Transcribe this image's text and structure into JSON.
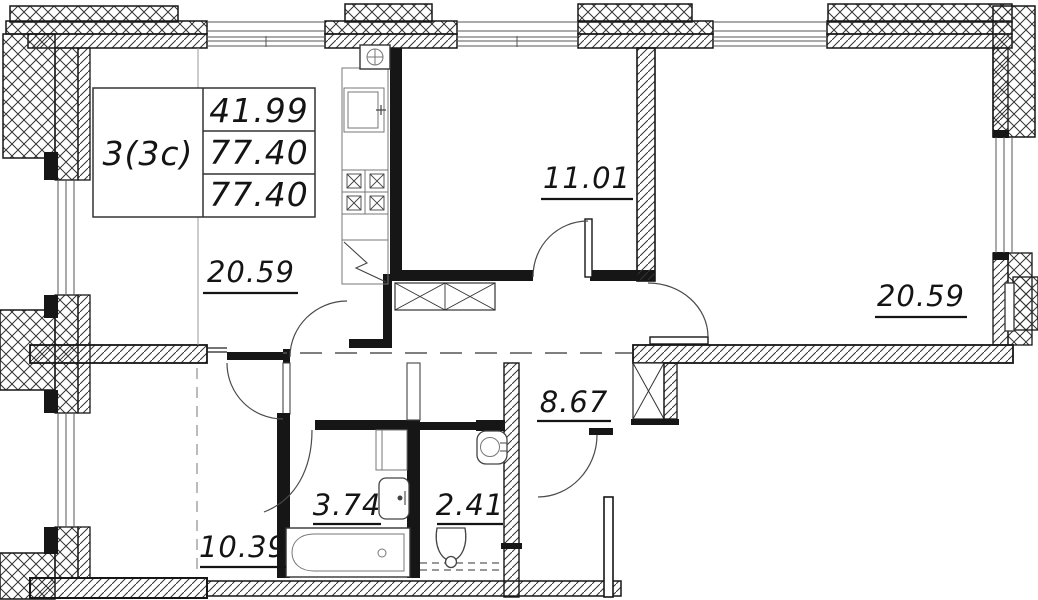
{
  "plan": {
    "title_block": {
      "unit_type": "3(3c)",
      "area_rows": [
        "41.99",
        "77.40",
        "77.40"
      ]
    },
    "room_labels": {
      "living": "20.59",
      "bedroom_top": "11.01",
      "bedroom_right": "20.59",
      "hallway": "8.67",
      "room_bottom_left": "10.39",
      "bathroom": "3.74",
      "wc": "2.41"
    },
    "colors": {
      "ink": "#161616",
      "hatch_line": "#333333",
      "background": "#ffffff"
    }
  }
}
